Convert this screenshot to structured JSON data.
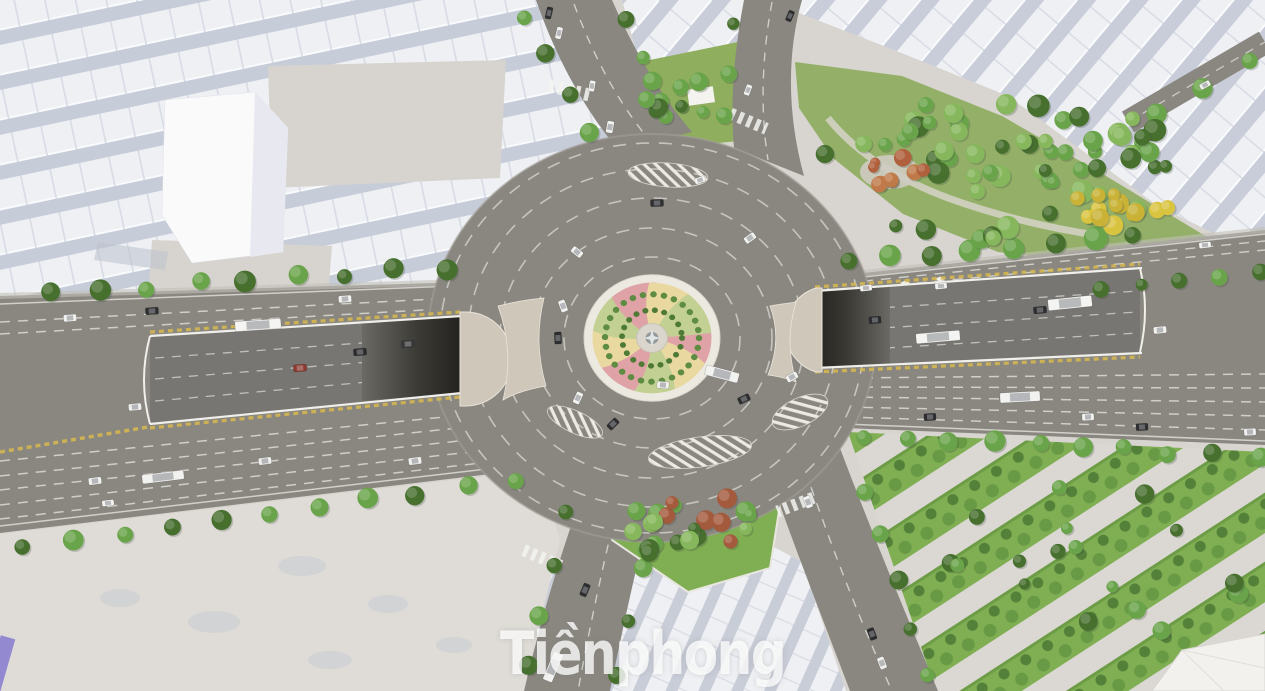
{
  "meta": {
    "description": "Aerial 3D architectural rendering of a planned city roundabout with twin underpass tunnels, tree-lined avenues, residential massing blocks and landscaped parks",
    "render_type": "3d-visualization",
    "view": "bird's-eye"
  },
  "watermark": {
    "text": "Tiềnphong",
    "color": "rgba(255,255,255,0.78)"
  },
  "palette": {
    "ground": "#d8d5d0",
    "plaza": "#dfdcd7",
    "road": "#8a8780",
    "sunken_road": "#787672",
    "tunnel_dark": "#23221e",
    "lane_line": "#dcdbd5",
    "yellow_line": "#d7b84e",
    "wall": "#f0efe9",
    "cap": "#cfc7ba",
    "ring_dash": "#cccbc5",
    "island_ring": "#ece9e1",
    "island_pink": "#dfa2a6",
    "island_cream": "#e9d9a1",
    "island_green": "#c3d093",
    "shrub_green": "#4e7a36",
    "grass": "#7fae53",
    "tree": "#6aa44a",
    "tree_dark": "#47702f",
    "tree_light": "#86b75c",
    "tree_yellow": "#d9c440",
    "tree_red": "#b0603c",
    "house_light": "#eef0f4",
    "house_shadow": "#c7ccd9",
    "cube": "#fafafb"
  },
  "scene": {
    "roundabout": {
      "center_x": 652,
      "center_y": 338,
      "island_style": "spiral pinwheel planting with central monument"
    },
    "tree_rows": [
      [
        50,
        293,
        445,
        268,
        9,
        9
      ],
      [
        25,
        548,
        515,
        480,
        11,
        9
      ],
      [
        565,
        515,
        528,
        668,
        4,
        8
      ],
      [
        658,
        515,
        618,
        675,
        4,
        8
      ],
      [
        523,
        15,
        590,
        132,
        4,
        8
      ],
      [
        627,
        18,
        663,
        100,
        3,
        7
      ],
      [
        733,
        25,
        723,
        118,
        3,
        7
      ],
      [
        850,
        260,
        1135,
        237,
        8,
        10
      ],
      [
        862,
        437,
        1258,
        456,
        10,
        9
      ],
      [
        1158,
        112,
        1252,
        62,
        3,
        9
      ],
      [
        1100,
        289,
        1258,
        272,
        5,
        7
      ],
      [
        862,
        490,
        930,
        676,
        5,
        8
      ]
    ],
    "tree_clusters": [
      {
        "cx": 1005,
        "cy": 168,
        "rx": 185,
        "ry": 72,
        "n": 62,
        "r": 9,
        "colors": [
          "#6aa44a",
          "#47702f",
          "#86b75c"
        ]
      },
      {
        "cx": 1118,
        "cy": 207,
        "rx": 58,
        "ry": 20,
        "n": 13,
        "r": 8,
        "colors": [
          "#d9c440",
          "#c9b236"
        ]
      },
      {
        "cx": 892,
        "cy": 170,
        "rx": 36,
        "ry": 16,
        "n": 9,
        "r": 7,
        "colors": [
          "#b0603c",
          "#c07a4a"
        ]
      },
      {
        "cx": 678,
        "cy": 100,
        "rx": 45,
        "ry": 28,
        "n": 10,
        "r": 8,
        "colors": [
          "#6aa44a",
          "#47702f"
        ]
      },
      {
        "cx": 697,
        "cy": 527,
        "rx": 72,
        "ry": 42,
        "n": 22,
        "r": 8,
        "colors": [
          "#6aa44a",
          "#47702f",
          "#86b75c",
          "#a45a3c"
        ]
      },
      {
        "cx": 1090,
        "cy": 570,
        "rx": 160,
        "ry": 88,
        "n": 18,
        "r": 8,
        "colors": [
          "#6aa44a",
          "#47702f"
        ]
      }
    ],
    "cars": [
      [
        70,
        318,
        13,
        7,
        -4,
        "#f1f1ef"
      ],
      [
        152,
        311,
        13,
        7,
        -4,
        "#2f2f31"
      ],
      [
        258,
        325,
        46,
        10,
        -4,
        "#f4f4f2"
      ],
      [
        345,
        299,
        13,
        7,
        -4,
        "#f2f2f0"
      ],
      [
        135,
        407,
        13,
        7,
        -5,
        "#f0f0ee"
      ],
      [
        300,
        368,
        13,
        7,
        -4,
        "#8e3b2f"
      ],
      [
        360,
        352,
        13,
        7,
        -4,
        "#2c2c2e"
      ],
      [
        408,
        344,
        13,
        7,
        -4,
        "#3a3a3c"
      ],
      [
        95,
        481,
        13,
        7,
        -7,
        "#f2f2f0"
      ],
      [
        163,
        477,
        42,
        9,
        -7,
        "#f1f1ef"
      ],
      [
        108,
        503,
        12,
        6,
        -7,
        "#f4f4f2"
      ],
      [
        265,
        461,
        13,
        7,
        -7,
        "#eeeeec"
      ],
      [
        415,
        461,
        13,
        7,
        -7,
        "#f0f0ee"
      ],
      [
        549,
        13,
        12,
        6,
        103,
        "#303032"
      ],
      [
        559,
        33,
        12,
        6,
        103,
        "#f2f2f0"
      ],
      [
        592,
        86,
        11,
        6,
        100,
        "#f1f1ef"
      ],
      [
        610,
        127,
        12,
        7,
        100,
        "#f3f3f1"
      ],
      [
        790,
        16,
        11,
        6,
        -67,
        "#2c2c2e"
      ],
      [
        748,
        90,
        11,
        6,
        -70,
        "#f1f1ef"
      ],
      [
        657,
        203,
        13,
        7,
        -2,
        "#2f2f31"
      ],
      [
        577,
        252,
        12,
        7,
        38,
        "#f2f2f0"
      ],
      [
        563,
        306,
        12,
        7,
        70,
        "#f2f2f0"
      ],
      [
        558,
        338,
        12,
        7,
        88,
        "#2d2d2f"
      ],
      [
        578,
        398,
        12,
        7,
        115,
        "#f3f3f1"
      ],
      [
        613,
        424,
        12,
        7,
        135,
        "#2f2f31"
      ],
      [
        663,
        385,
        12,
        7,
        5,
        "#f2f2f0"
      ],
      [
        722,
        374,
        34,
        10,
        15,
        "#f2f2f0"
      ],
      [
        744,
        399,
        12,
        7,
        155,
        "#2e2e30"
      ],
      [
        792,
        377,
        12,
        7,
        150,
        "#f2f2f0"
      ],
      [
        750,
        238,
        12,
        7,
        -35,
        "#f1f1ef"
      ],
      [
        700,
        180,
        11,
        6,
        -18,
        "#f3f3f1"
      ],
      [
        866,
        288,
        12,
        6,
        -6,
        "#f2f2f0"
      ],
      [
        941,
        286,
        12,
        6,
        -6,
        "#f1f1ef"
      ],
      [
        1070,
        303,
        44,
        11,
        -6,
        "#f4f4f2"
      ],
      [
        1205,
        245,
        12,
        6,
        -6,
        "#f2f2f0"
      ],
      [
        938,
        337,
        44,
        10,
        -5,
        "#f4f4f2"
      ],
      [
        1040,
        310,
        13,
        7,
        -5,
        "#2e2e30"
      ],
      [
        1160,
        330,
        13,
        7,
        -5,
        "#f2f2f0"
      ],
      [
        875,
        320,
        12,
        7,
        -5,
        "#2c2c2e"
      ],
      [
        1020,
        397,
        40,
        10,
        -3,
        "#f2f2f0"
      ],
      [
        930,
        417,
        12,
        7,
        -3,
        "#2f2f31"
      ],
      [
        1088,
        417,
        12,
        7,
        -3,
        "#f2f2f0"
      ],
      [
        1142,
        427,
        12,
        7,
        -3,
        "#303032"
      ],
      [
        1250,
        432,
        12,
        7,
        -3,
        "#f1f1ef"
      ],
      [
        553,
        667,
        30,
        10,
        113,
        "#f3f3f1"
      ],
      [
        585,
        590,
        13,
        7,
        113,
        "#2f2f31"
      ],
      [
        808,
        502,
        12,
        7,
        69,
        "#f2f2f0"
      ],
      [
        872,
        634,
        12,
        7,
        69,
        "#2c2c2e"
      ],
      [
        882,
        663,
        12,
        7,
        69,
        "#f1f1ef"
      ],
      [
        1205,
        85,
        11,
        6,
        -28,
        "#f2f2f0"
      ]
    ]
  }
}
